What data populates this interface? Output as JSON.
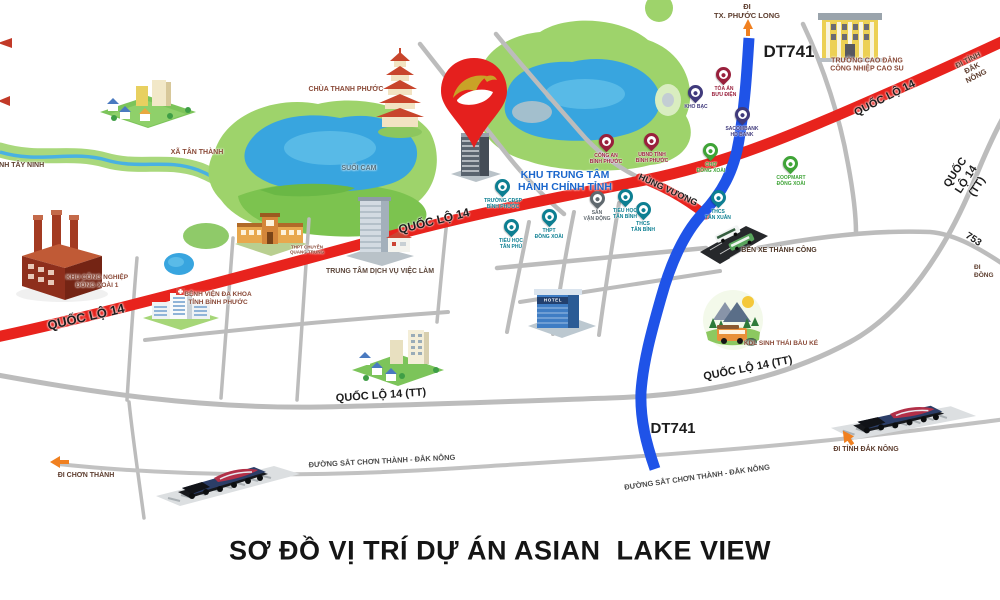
{
  "title": "SƠ ĐỒ VỊ TRÍ DỰ ÁN ASIAN  LAKE VIEW",
  "colors": {
    "ql14_road": "#e8231d",
    "dt741_road": "#1f53e8",
    "minor_road": "#bcbcbc",
    "forest": "#9ed36b",
    "lake": "#38a5df",
    "admin_text": "#1a66cc",
    "pin_teal": "#0d7f92",
    "pin_maroon": "#99203c",
    "pin_purple": "#403a7c",
    "pin_green": "#3fa437",
    "pin_gray": "#5f686e",
    "project_pin": "#e5201e",
    "direction_arrow": "#f08020"
  },
  "roads": {
    "ql14": "QUỐC LỘ 14",
    "ql14_tt": "QUỐC LỘ 14 (TT)",
    "dt741": "DT741",
    "hung_vuong": "HÙNG VƯƠNG",
    "route_753": "753",
    "railway": "ĐƯỜNG SẮT CHƠN THÀNH - ĐẮK NÔNG"
  },
  "directions": {
    "tay_ninh": "ĐI TỈNH TÂY NINH",
    "phuoc_long": "ĐI\nTX. PHƯỚC LONG",
    "dak_nong_ql14": "ĐI TỈNH ĐẮK NÔNG",
    "dak_nong_rail": "ĐI TỈNH ĐẮK NÔNG",
    "chon_thanh": "ĐI CHƠN THÀNH",
    "dong_phu": "ĐI ĐỒNG"
  },
  "places": {
    "xa_tan_thanh": "XÃ TÂN THÀNH",
    "chua_thanh_phuoc": "CHÙA THANH PHƯỚC",
    "suoi_cam": "SUỐI CAM",
    "khu_trung_tam": "KHU TRUNG TÂM\nHÀNH CHÍNH TỈNH",
    "kcn_dong_xoai": "KHU CÔNG NGHIỆP\nĐỒNG XOÀI 1",
    "benh_vien": "BỆNH VIỆN ĐA KHOA\nTỈNH BÌNH PHƯỚC",
    "thpt_chuyen": "THPT CHUYÊN\nQUANG TRUNG",
    "trung_tam_viec_lam": "TRUNG TÂM DỊCH VỤ VIỆC LÀM",
    "cao_dang_cao_su": "TRƯỜNG CAO ĐẲNG\nCÔNG NHIỆP CAO SU",
    "ben_xe": "BẾN XE THÀNH CÔNG",
    "kdl_bau_ke": "KDL SINH THÁI BÀU KÉ",
    "hotel_sign": "HOTEL"
  },
  "pins": {
    "truong_cdsp": {
      "label": "TRƯỜNG CĐSP\nBÌNH PHƯỚC"
    },
    "tieu_hoc_tan_phu": {
      "label": "TIỂU HỌC\nTÂN PHÚ"
    },
    "thpt_dong_xoai": {
      "label": "THPT\nĐỒNG XOÀI"
    },
    "san_van_dong": {
      "label": "SÂN\nVẬN ĐỘNG"
    },
    "tieu_hoc_tan_binh": {
      "label": "TIỂU HỌC\nTÂN BÌNH"
    },
    "thcs_tan_binh": {
      "label": "THCS\nTÂN BÌNH"
    },
    "thcs_tan_xuan": {
      "label": "THCS\nTÂN XUÂN"
    },
    "cho_dong_xoai": {
      "label": "CHỢ\nĐỒNG XOÀI"
    },
    "coopmart": {
      "label": "COOPMART\nĐỒNG XOÀI"
    },
    "cong_an": {
      "label": "CÔNG AN\nBÌNH PHƯỚC"
    },
    "ubnd_tinh": {
      "label": "UBND TỈNH\nBÌNH PHƯỚC"
    },
    "toa_an_buu_dien": {
      "label": "TÒA ÁN\nBƯU ĐIỆN"
    },
    "kho_bac": {
      "label": "KHO BẠC"
    },
    "sacombank": {
      "label": "SACOMBANK\nHD BANK"
    }
  }
}
